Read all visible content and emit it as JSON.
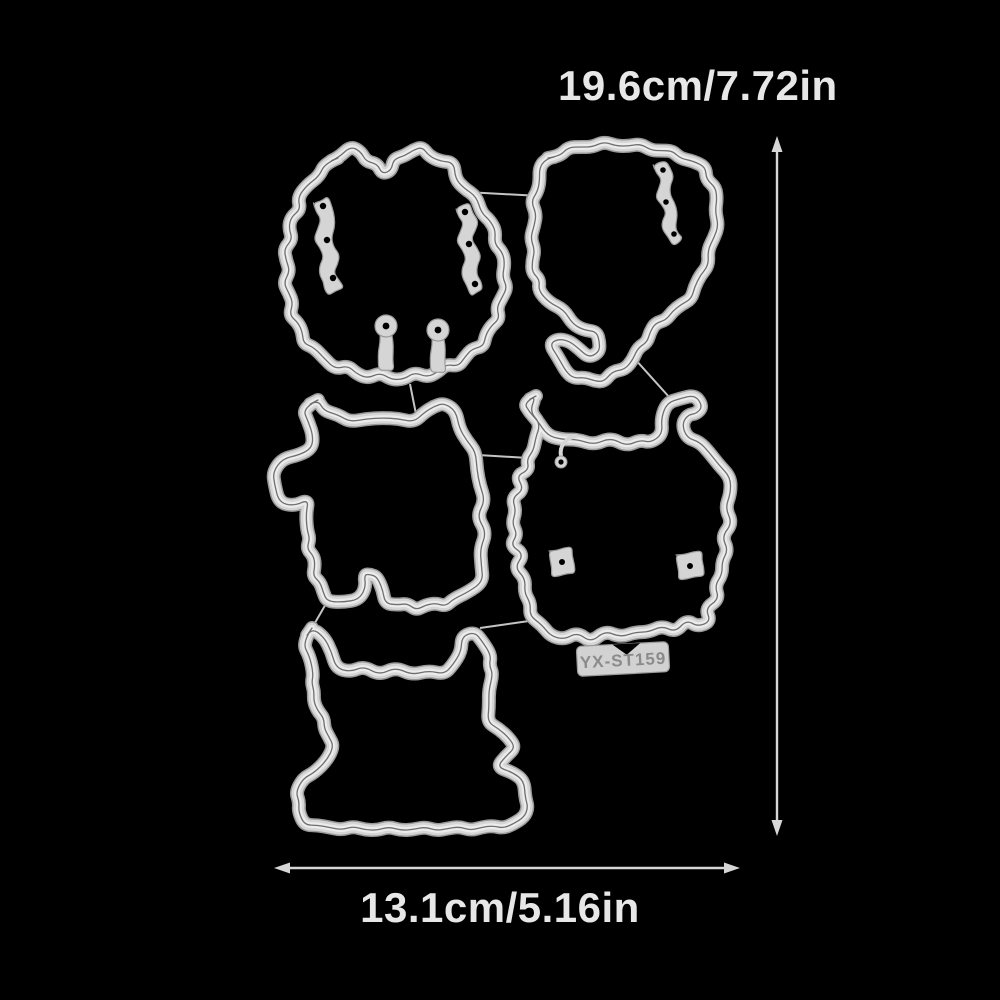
{
  "background_color": "#000000",
  "annotations": {
    "height_label": "19.6cm/7.72in",
    "width_label": "13.1cm/5.16in",
    "text_color": "#e7e7e7",
    "arrow_color": "#d6d6d6"
  },
  "product": {
    "code_label": "YX-ST159",
    "die_color": "#d5d5d5",
    "die_edge_color": "#999999",
    "die_groove_color": "#6f6f6f",
    "dies": [
      {
        "label": "furry horned monster (top left)"
      },
      {
        "label": "monster with curled tail (top right)"
      },
      {
        "label": "horned monster with side arm (middle left)"
      },
      {
        "label": "wide-armed monster with code tag (middle right)"
      },
      {
        "label": "monster on rectangular base (bottom)"
      }
    ]
  }
}
